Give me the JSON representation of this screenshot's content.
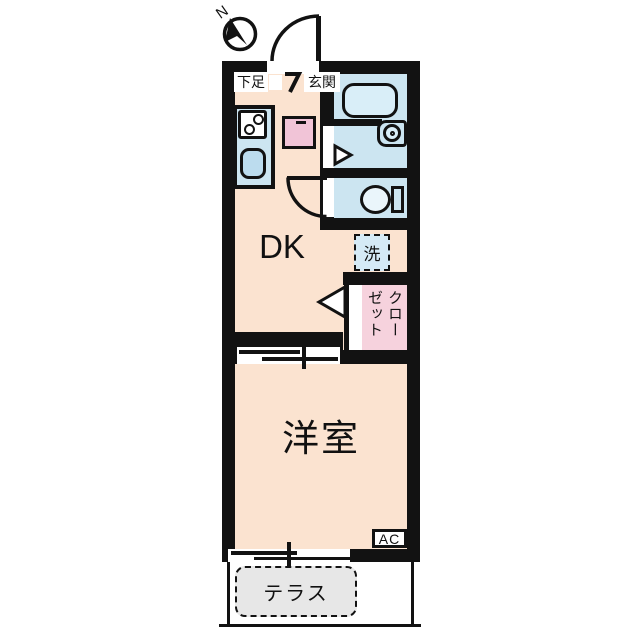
{
  "floorplan": {
    "compass": {
      "label": "N"
    },
    "entrance": {
      "label": "玄関",
      "shoe_label": "下足"
    },
    "rooms": {
      "dk": {
        "label": "DK"
      },
      "western": {
        "label": "洋室"
      },
      "closet": {
        "label": "クローゼット"
      },
      "terrace": {
        "label": "テラス"
      }
    },
    "fixtures": {
      "washer_label": "洗",
      "ac_label": "AC"
    },
    "colors": {
      "wall": "#121212",
      "floor": "#FBE3D0",
      "wet": "#CCE5F1",
      "tub": "#D9EEF8",
      "sink": "#BCDCEE",
      "closet": "#F6D2DD",
      "appliance": "#F1C4D7",
      "washer": "#D5EAF6",
      "terrace": "#E7E7E7",
      "toilet": "#EAF5FB"
    }
  }
}
